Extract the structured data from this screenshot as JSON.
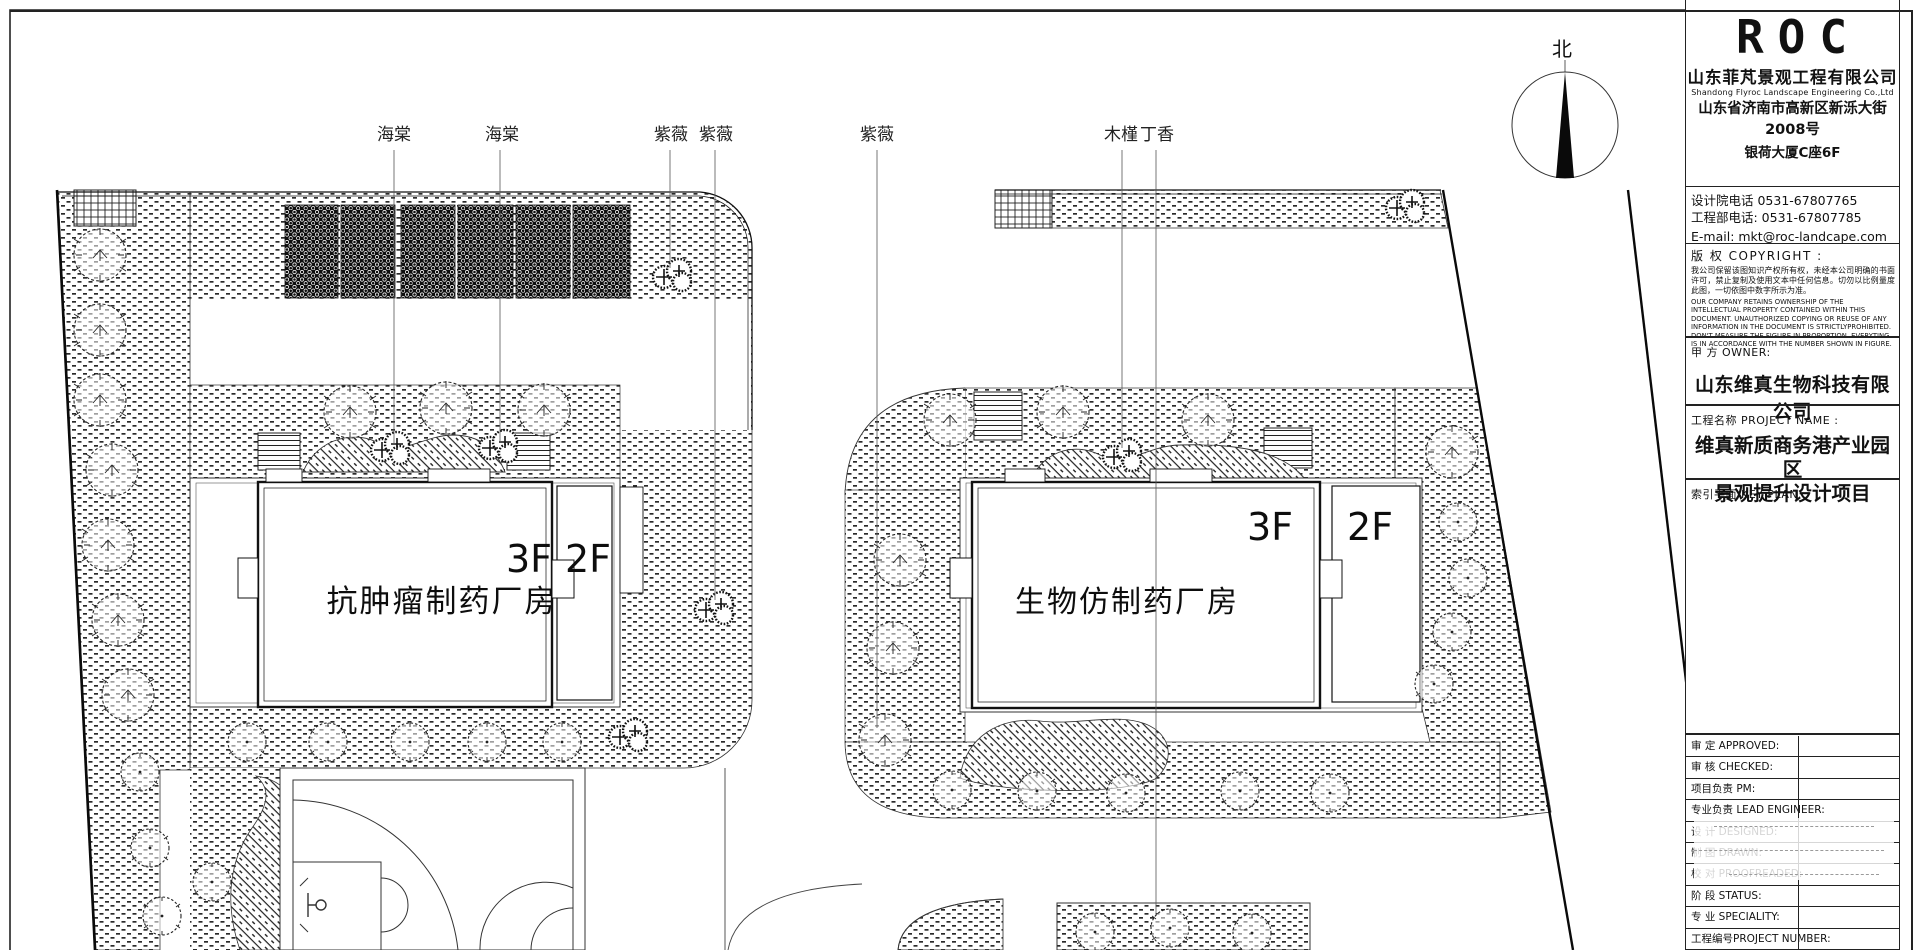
{
  "colors": {
    "ink": "#1a1a1a",
    "paper": "#ffffff"
  },
  "plan": {
    "north_label": "北",
    "plant_labels": [
      {
        "text": "海棠"
      },
      {
        "text": "海棠"
      },
      {
        "text": "紫薇"
      },
      {
        "text": "紫薇"
      },
      {
        "text": "紫薇"
      },
      {
        "text": "木槿"
      },
      {
        "text": "丁香"
      }
    ],
    "buildings": [
      {
        "name": "抗肿瘤制药厂房",
        "floors_main": "3F",
        "floors_wing": "2F"
      },
      {
        "name": "生物仿制药厂房",
        "floors_main": "3F",
        "floors_wing": "2F"
      }
    ]
  },
  "titleblock": {
    "logo": "ROC",
    "company_cn": "山东菲芃景观工程有限公司",
    "company_en": "Shandong Flyroc Landscape Engineering Co.,Ltd",
    "address_line1": "山东省济南市高新区新泺大街2008号",
    "address_line2": "银荷大厦C座6F",
    "phone1": "设计院电话 0531-67807765",
    "phone2": "工程部电话: 0531-67807785",
    "email": "E-mail: mkt@roc-landcape.com",
    "copyright_title": "版 权 COPYRIGHT :",
    "copyright_cn": "我公司保留该图知识产权所有权，未经本公司明确的书面许可，禁止复制及使用文本中任何信息。切勿以比例量度此图，一切依图中数字所示为准。",
    "copyright_en": "OUR COMPANY RETAINS OWNERSHIP OF THE INTELLECTUAL PROPERTY CONTAINED WITHIN THIS DOCUMENT. UNAUTHORIZED COPYING OR REUSE OF ANY INFORMATION IN THE DOCUMENT IS STRICTLYPROHIBITED. DON'T MEASURE THE FIGURE IN PROPORTION. EVERYTING IS IN ACCORDANCE WITH THE NUMBER SHOWN IN FIGURE.",
    "owner_label": "甲  方 OWNER:",
    "owner_name": "山东维真生物科技有限公司",
    "project_label": "工程名称 PROJECT NAME :",
    "project_name_line1": "维真新质商务港产业园区",
    "project_name_line2": "景观提升设计项目",
    "keyplan_label": "索引平面 KEY PLAN :",
    "table_rows": [
      "审 定 APPROVED:",
      "审 核 CHECKED:",
      "项目负责 PM:",
      "专业负责 LEAD ENGINEER:",
      "设 计 DESIGNED:",
      "制 图 DRAWN:",
      "校 对 PROOFREADED:",
      "阶 段 STATUS:",
      "专 业 SPECIALITY:",
      "工程编号PROJECT NUMBER:"
    ]
  }
}
